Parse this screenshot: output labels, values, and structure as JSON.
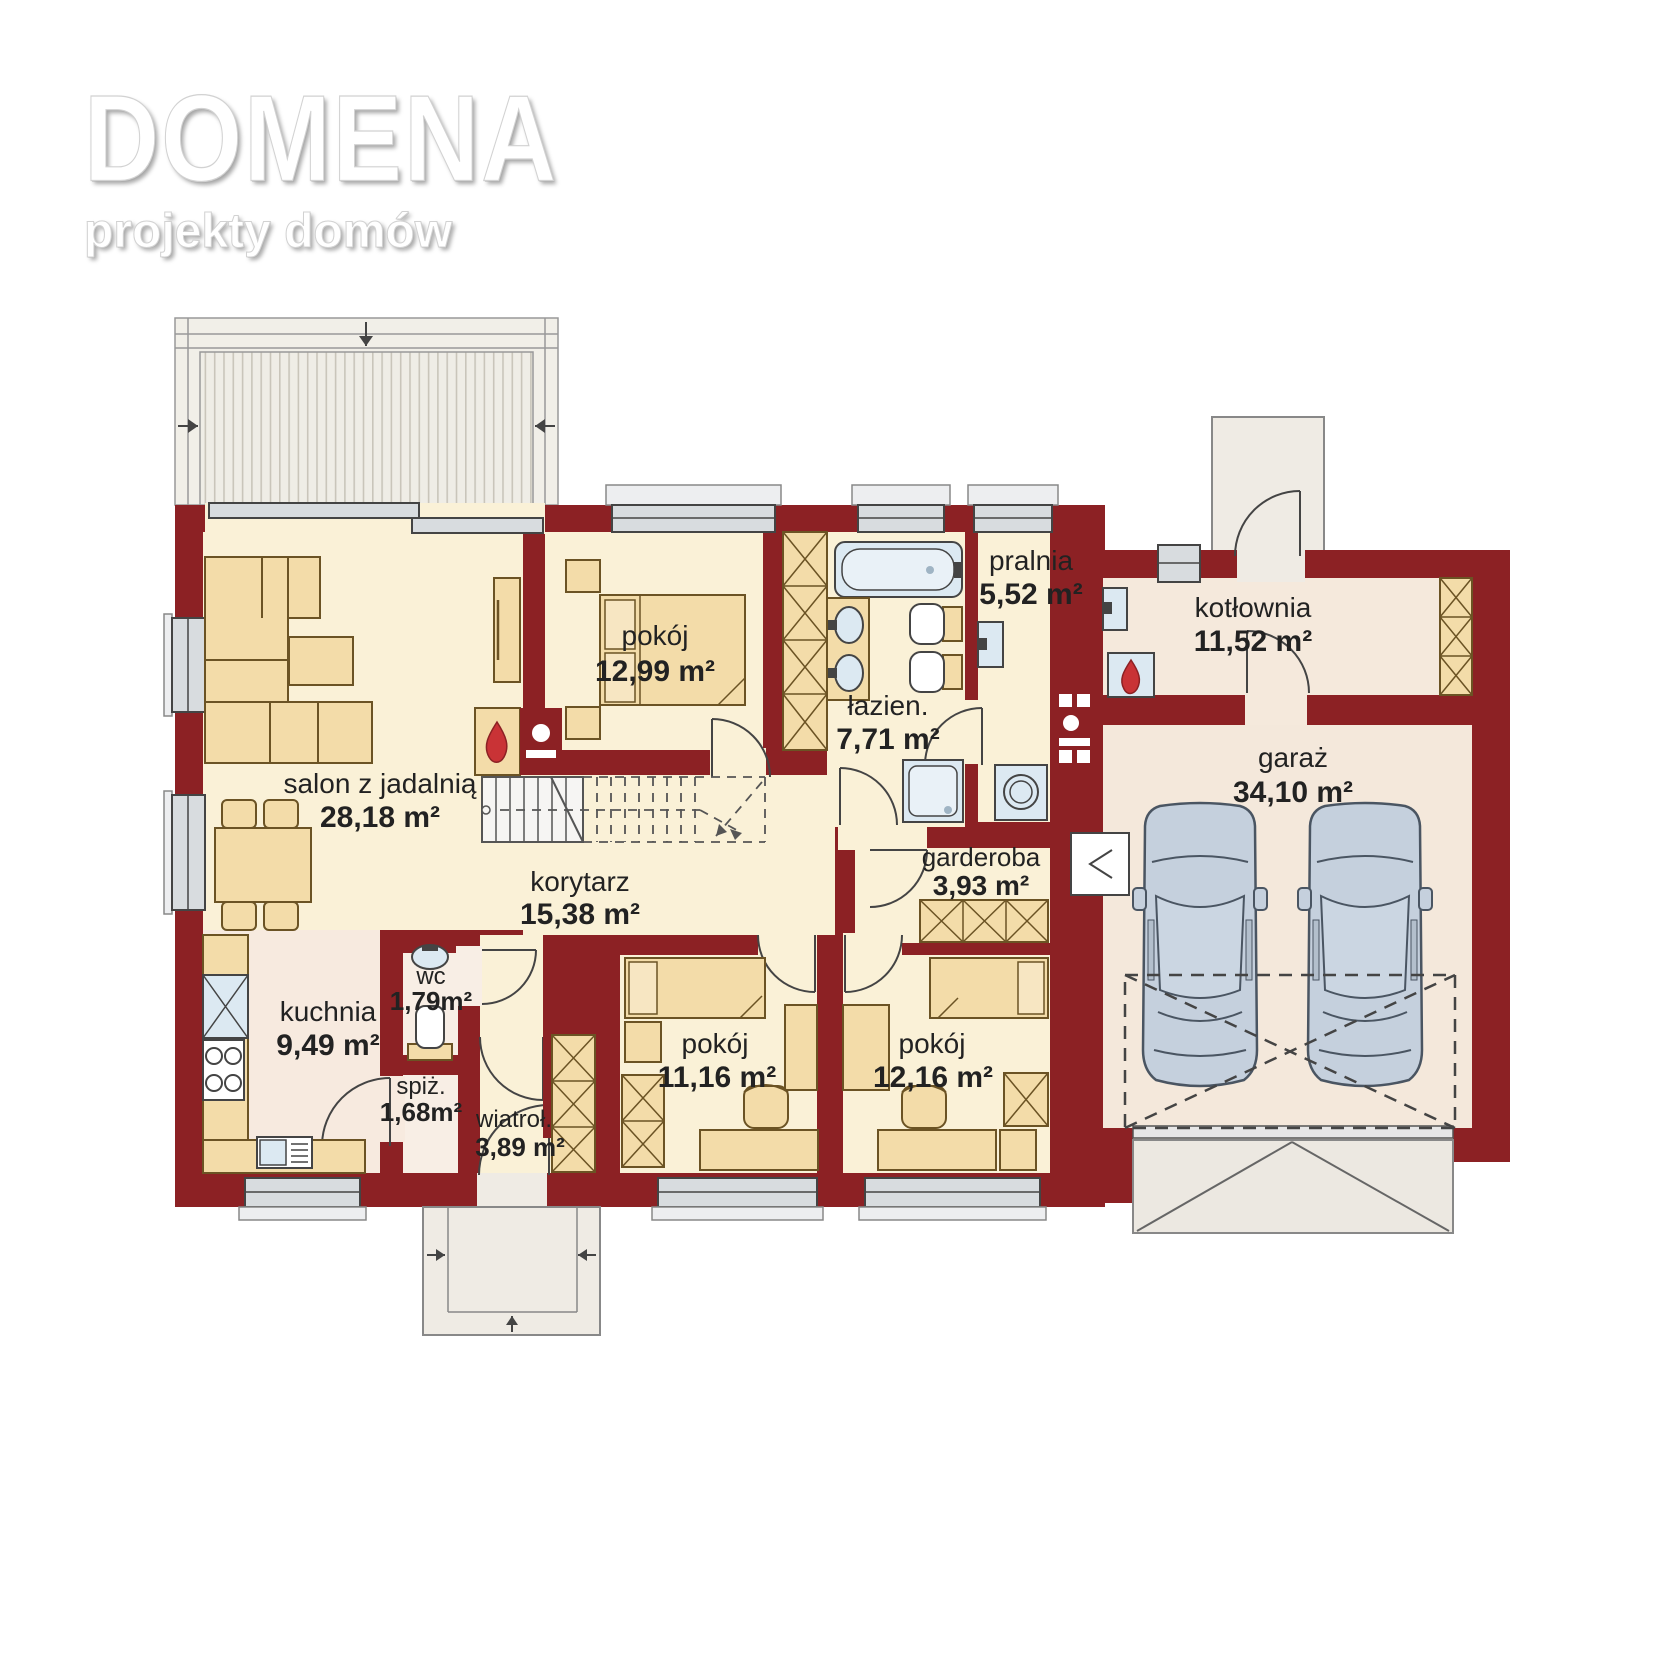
{
  "brand": {
    "name": "DOMENA",
    "tagline": "projekty domów"
  },
  "plan": {
    "type": "floor-plan",
    "rooms": [
      {
        "id": "salon",
        "name": "salon z jadalnią",
        "area": "28,18 m²"
      },
      {
        "id": "pokoj-1",
        "name": "pokój",
        "area": "12,99 m²"
      },
      {
        "id": "lazienka",
        "name": "łazien.",
        "area": "7,71 m²"
      },
      {
        "id": "pralnia",
        "name": "pralnia",
        "area": "5,52 m²"
      },
      {
        "id": "kotlownia",
        "name": "kotłownia",
        "area": "11,52 m²"
      },
      {
        "id": "garaz",
        "name": "garaż",
        "area": "34,10 m²"
      },
      {
        "id": "garderoba",
        "name": "garderoba",
        "area": "3,93 m²"
      },
      {
        "id": "korytarz",
        "name": "korytarz",
        "area": "15,38 m²"
      },
      {
        "id": "kuchnia",
        "name": "kuchnia",
        "area": "9,49 m²"
      },
      {
        "id": "wc",
        "name": "wc",
        "area": "1,79m²"
      },
      {
        "id": "spizarnia",
        "name": "spiż.",
        "area": "1,68m²"
      },
      {
        "id": "wiatrolap",
        "name": "wiatroł.",
        "area": "3,89 m²"
      },
      {
        "id": "pokoj-2",
        "name": "pokój",
        "area": "11,16 m²"
      },
      {
        "id": "pokoj-3",
        "name": "pokój",
        "area": "12,16 m²"
      }
    ],
    "colors": {
      "wall": "#8C2124",
      "floor_main": "#FAF1D7",
      "floor_service": "#F7EADF",
      "floor_wing": "#F5E9DC",
      "furniture": "#F3DCA9",
      "fixture": "#DCE9F2",
      "terrace": "#F1EFE8",
      "car": "#C5D0DD"
    }
  }
}
